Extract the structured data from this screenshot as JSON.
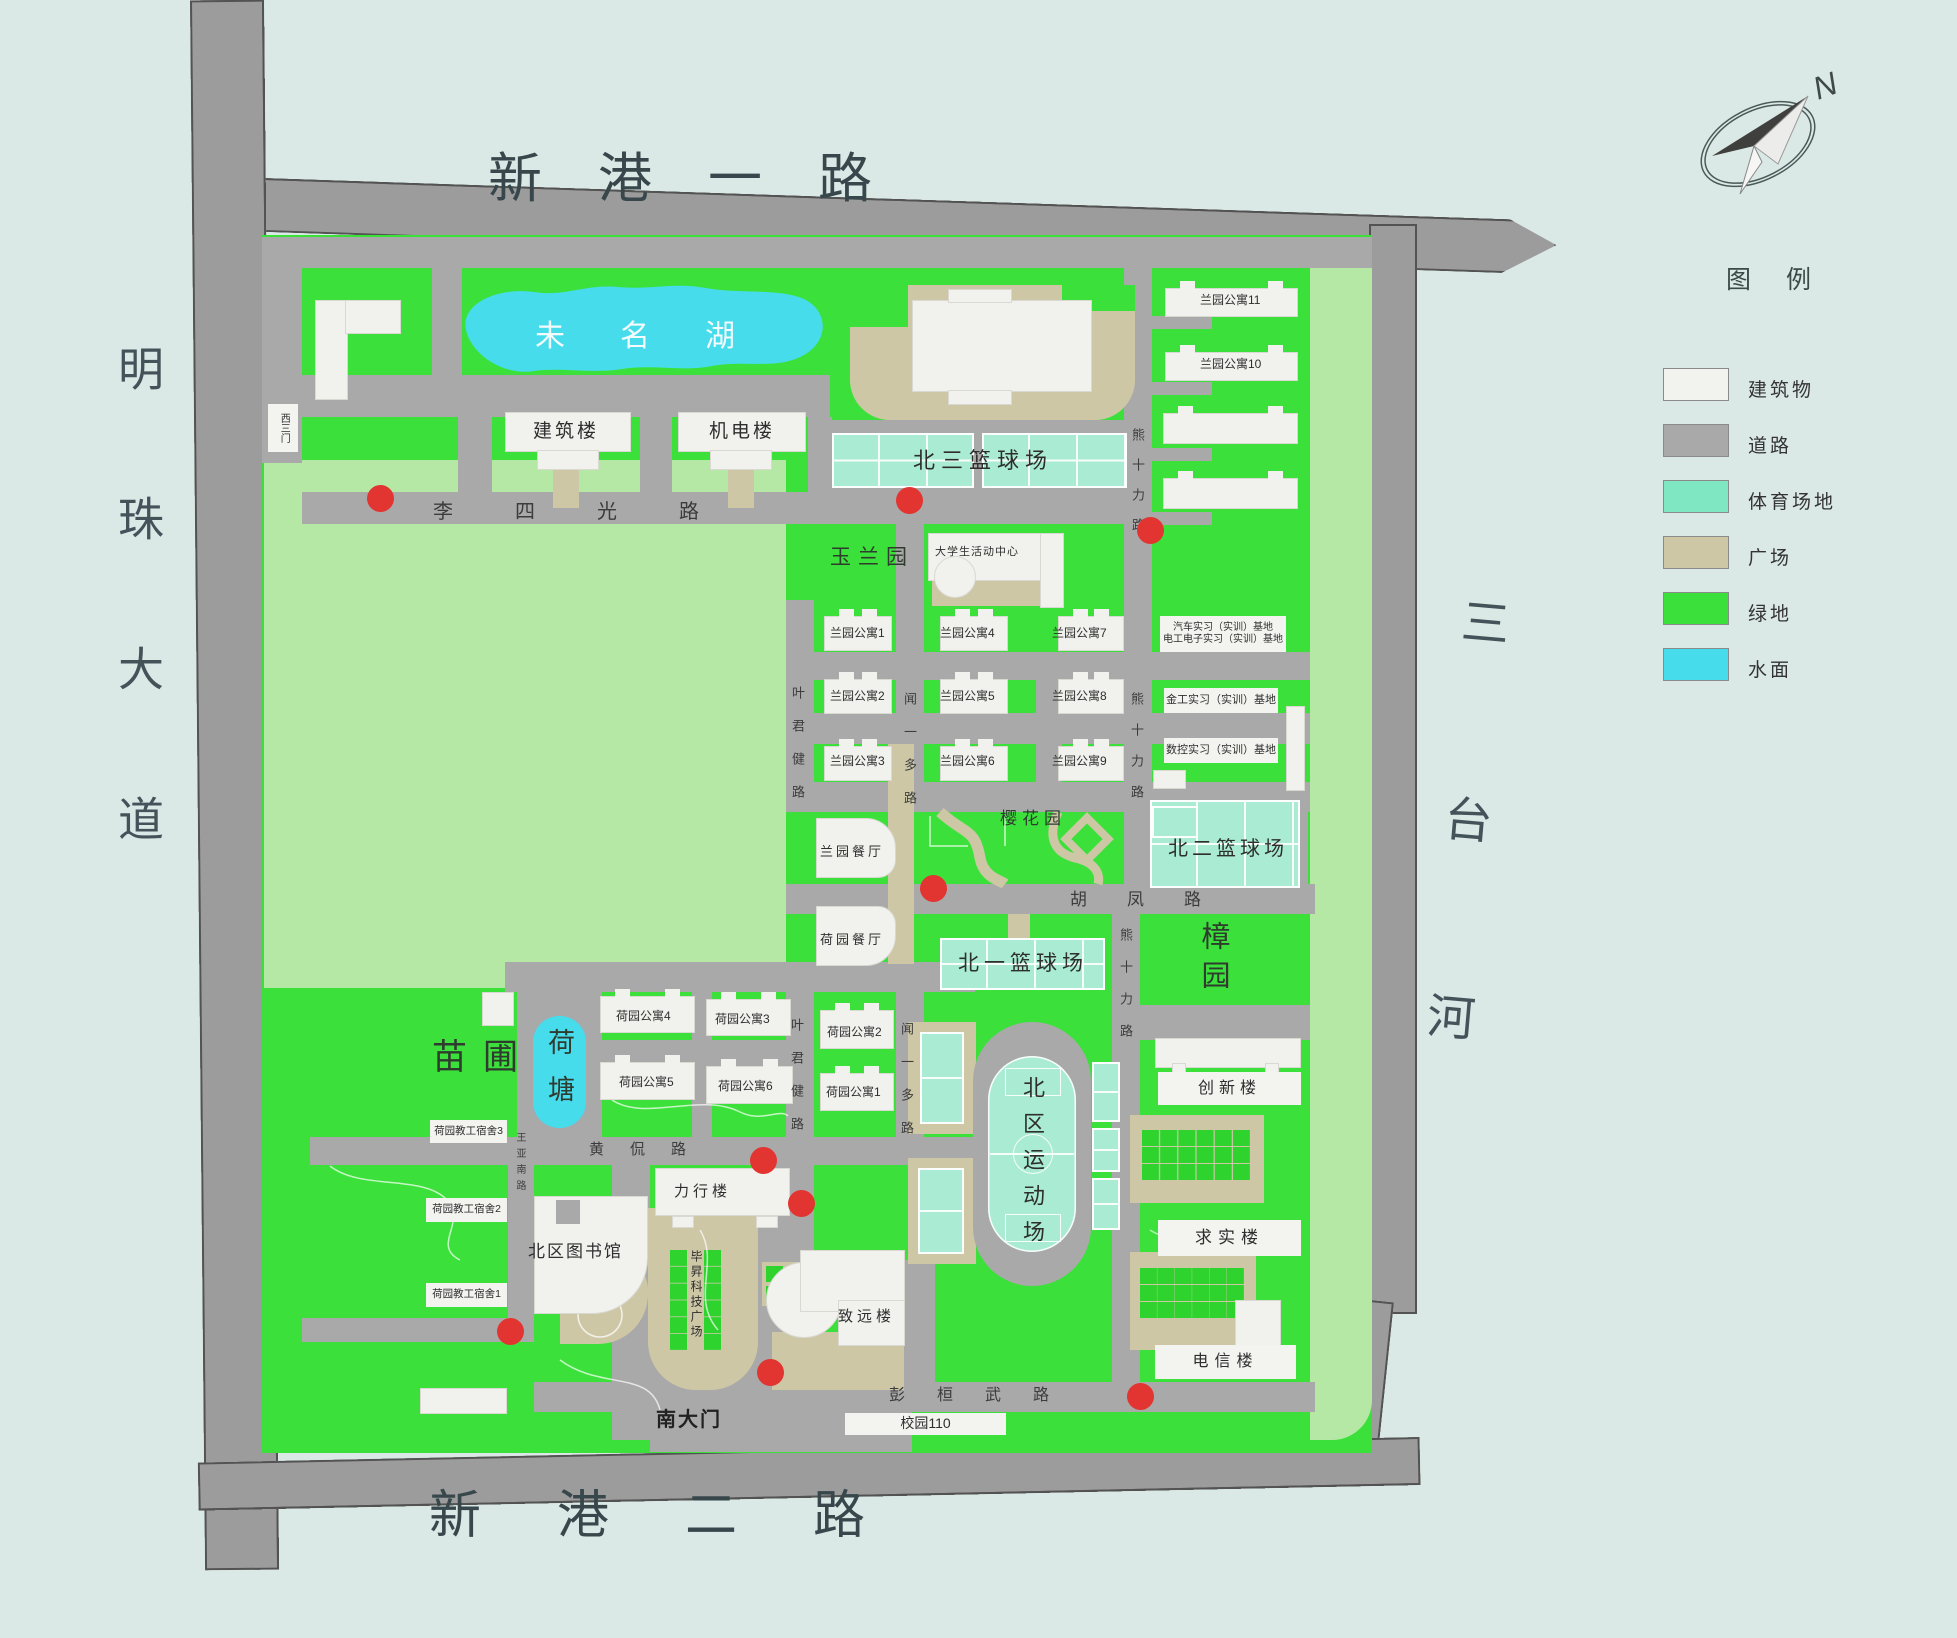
{
  "colors": {
    "background": "#dae9e6",
    "campus_green": "#3be13a",
    "light_green": "#b5e8a5",
    "boundary_road": "#9c9c9c",
    "inner_road": "#a9a9a9",
    "building": "#f1f1ee",
    "plaza": "#cdc7a6",
    "sports": "#a9ecd3",
    "water": "#46dcec",
    "alarm_dot": "#e23430"
  },
  "compass": {
    "north_label": "N"
  },
  "legend": {
    "title": "图 例",
    "items": [
      {
        "label": "建筑物",
        "color": "#f2f2ee"
      },
      {
        "label": "道路",
        "color": "#a9a9a9"
      },
      {
        "label": "体育场地",
        "color": "#7fe8c2"
      },
      {
        "label": "广场",
        "color": "#cdc7a5"
      },
      {
        "label": "绿地",
        "color": "#3be13a"
      },
      {
        "label": "水面",
        "color": "#46dcec"
      }
    ]
  },
  "boundary": {
    "road_top": "新港一路",
    "avenue_left": "明珠大道",
    "river_right": "三台河",
    "road_bottom": "新港二路"
  },
  "gates": {
    "west": "西三门",
    "south": "南大门"
  },
  "roads": {
    "lisiguang": "李四光路",
    "yejunjian": "叶君健路",
    "wenyiduo": "闻一多路",
    "xiongshili": "熊十力路",
    "hufeng": "胡凤路",
    "huangkan": "黄侃路",
    "wangyanan": "王亚南路",
    "penghuanwu": "彭桓武路"
  },
  "water": {
    "lake": "未名湖",
    "pond": "荷塘"
  },
  "gardens": {
    "yulan": "玉兰园",
    "yinghua": "樱花园",
    "zhang": "樟园",
    "miaopu": "苗圃"
  },
  "sports": {
    "bb3": "北三篮球场",
    "bb2": "北二篮球场",
    "bb1": "北一篮球场",
    "stadium": "北区运动场"
  },
  "buildings": {
    "jianzhu": "建筑楼",
    "jidian": "机电楼",
    "activity": "大学生活动中心",
    "lan1": "兰园公寓1",
    "lan2": "兰园公寓2",
    "lan3": "兰园公寓3",
    "lan4": "兰园公寓4",
    "lan5": "兰园公寓5",
    "lan6": "兰园公寓6",
    "lan7": "兰园公寓7",
    "lan8": "兰园公寓8",
    "lan9": "兰园公寓9",
    "lan10": "兰园公寓10",
    "lan11": "兰园公寓11",
    "qiche": "汽车实习（实训）基地",
    "diangong": "电工电子实习（实训）基地",
    "jingong": "金工实习（实训）基地",
    "shukong": "数控实习（实训）基地",
    "lan_canteen": "兰园餐厅",
    "he_canteen": "荷园餐厅",
    "he1": "荷园公寓1",
    "he2": "荷园公寓2",
    "he3": "荷园公寓3",
    "he4": "荷园公寓4",
    "he5": "荷园公寓5",
    "he6": "荷园公寓6",
    "hedorm1": "荷园教工宿舍1",
    "hedorm2": "荷园教工宿舍2",
    "hedorm3": "荷园教工宿舍3",
    "library": "北区图书馆",
    "lixing": "力行楼",
    "bisheng": "毕昇科技广场",
    "zhiyuan": "致远楼",
    "chuangxin": "创新楼",
    "qiushi": "求实楼",
    "dianxin": "电信楼",
    "campus110": "校园110"
  }
}
